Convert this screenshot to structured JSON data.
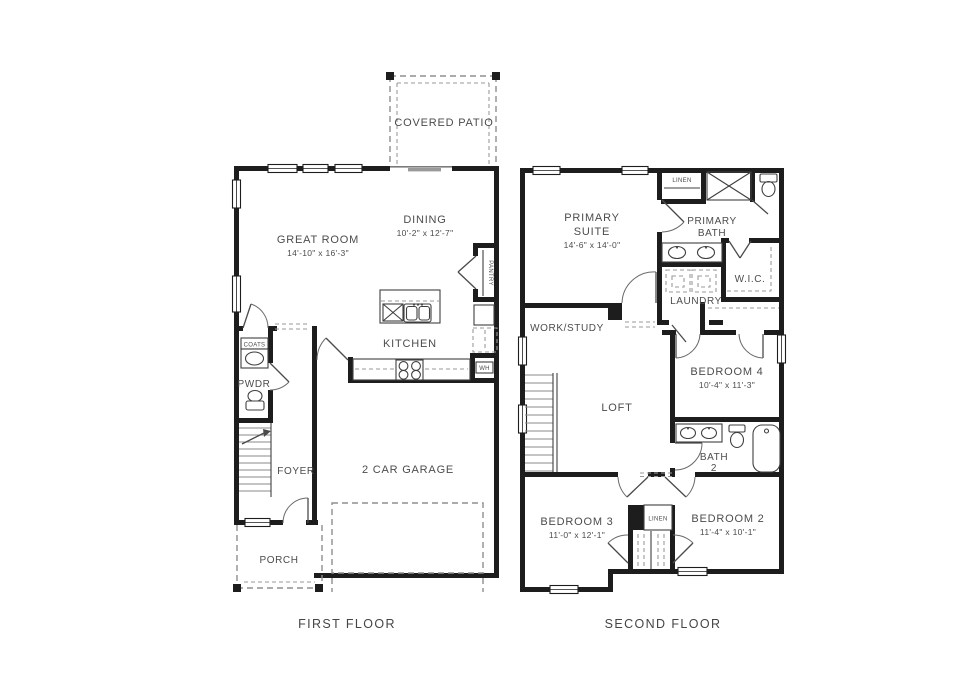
{
  "colors": {
    "wall": "#1d1d1d",
    "text": "#4c4c4c",
    "dashed_line": "#8f8f8f",
    "background": "#ffffff"
  },
  "first_floor": {
    "title": "FIRST FLOOR",
    "rooms": {
      "covered_patio": {
        "label": "COVERED PATIO"
      },
      "great_room": {
        "label": "GREAT ROOM",
        "dims": "14'-10\" x 16'-3\""
      },
      "dining": {
        "label": "DINING",
        "dims": "10'-2\" x 12'-7\""
      },
      "kitchen": {
        "label": "KITCHEN"
      },
      "pantry": {
        "label": "PANTRY"
      },
      "coats": {
        "label": "COATS"
      },
      "powder": {
        "label": "PWDR"
      },
      "foyer": {
        "label": "FOYER"
      },
      "garage": {
        "label": "2 CAR GARAGE"
      },
      "porch": {
        "label": "PORCH"
      },
      "water_heater": {
        "label": "WH"
      }
    }
  },
  "second_floor": {
    "title": "SECOND FLOOR",
    "rooms": {
      "primary_suite": {
        "line1": "PRIMARY",
        "line2": "SUITE",
        "dims": "14'-6\" x 14'-0\""
      },
      "linen_upper": {
        "label": "LINEN"
      },
      "primary_bath": {
        "line1": "PRIMARY",
        "line2": "BATH"
      },
      "wic": {
        "label": "W.I.C."
      },
      "laundry": {
        "label": "LAUNDRY"
      },
      "work_study": {
        "label": "WORK/STUDY"
      },
      "loft": {
        "label": "LOFT"
      },
      "bedroom4": {
        "label": "BEDROOM 4",
        "dims": "10'-4\" x 11'-3\""
      },
      "bath2": {
        "line1": "BATH",
        "line2": "2"
      },
      "bedroom3": {
        "label": "BEDROOM 3",
        "dims": "11'-0\" x 12'-1\""
      },
      "linen_lower": {
        "label": "LINEN"
      },
      "bedroom2": {
        "label": "BEDROOM 2",
        "dims": "11'-4\" x 10'-1\""
      }
    }
  }
}
